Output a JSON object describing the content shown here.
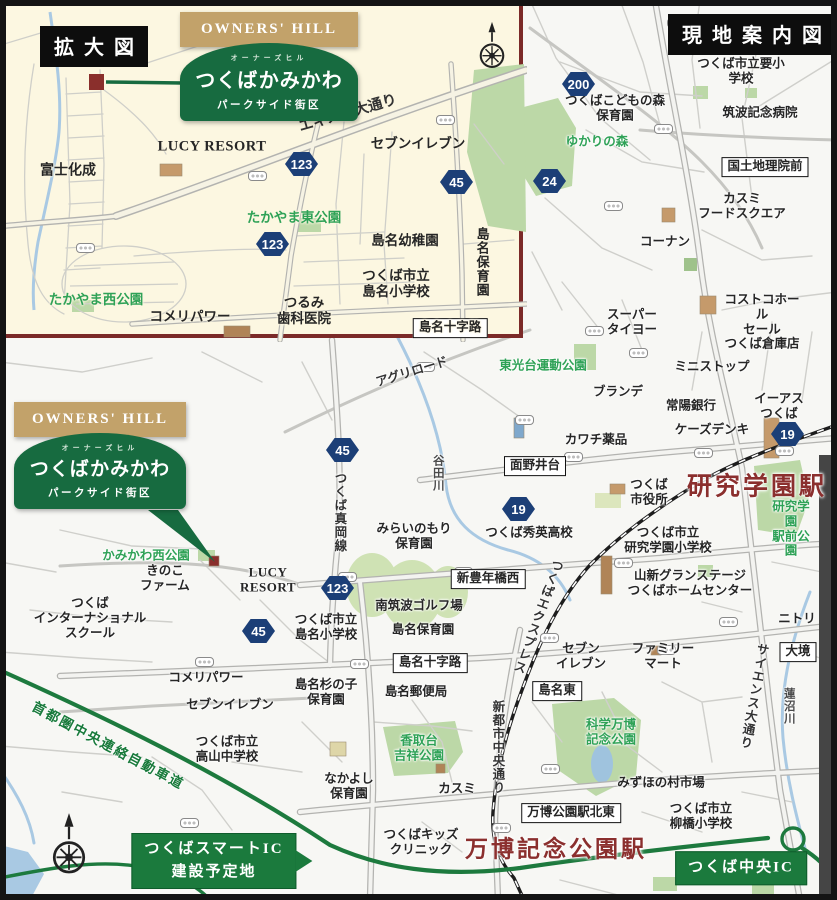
{
  "colors": {
    "accent_green": "#176b40",
    "station_red": "#8b2f2e",
    "shield_navy": "#1c3f77",
    "expressway_green": "#1d7a3e",
    "inset_bg": "#fcf7e1",
    "inset_border": "#7b2a28",
    "brand_gold": "#c2a26a"
  },
  "inset": {
    "title": "拡大図",
    "logo": {
      "brand": "OWNERS' HILL",
      "ruby": "オーナーズヒル",
      "name": "つくばかみかわ",
      "sub": "パークサイド街区"
    },
    "labels": [
      {
        "t": "かみかわ西公園",
        "x": 88,
        "y": 57,
        "c": "park",
        "fs": 14
      },
      {
        "t": "富士化成",
        "x": 64,
        "y": 168,
        "fs": 14
      },
      {
        "t": "LUCY RESORT",
        "x": 208,
        "y": 143,
        "c": "latin",
        "fs": 14.5
      },
      {
        "t": "エキスポ大通り",
        "x": 344,
        "y": 110,
        "c": "road",
        "r": -16,
        "fs": 14.5
      },
      {
        "t": "セブンイレブン",
        "x": 414,
        "y": 140,
        "fs": 13.5
      },
      {
        "t": "たかやま東公園",
        "x": 290,
        "y": 214,
        "c": "park",
        "fs": 13.5
      },
      {
        "t": "島名幼稚園",
        "x": 401,
        "y": 237,
        "fs": 13.5
      },
      {
        "t": "島名保育園",
        "x": 478,
        "y": 258,
        "c": "v",
        "fs": 13
      },
      {
        "t": "つくば市立\n島名小学校",
        "x": 392,
        "y": 280,
        "fs": 13.5
      },
      {
        "t": "つるみ\n歯科医院",
        "x": 300,
        "y": 307,
        "fs": 13.5
      },
      {
        "t": "たかやま西公園",
        "x": 92,
        "y": 296,
        "c": "park",
        "fs": 13.5
      },
      {
        "t": "コメリパワー",
        "x": 186,
        "y": 313,
        "fs": 13.5
      },
      {
        "t": "島名十字路",
        "x": 446,
        "y": 324,
        "c": "boxed"
      }
    ],
    "shields": [
      {
        "n": "123",
        "x": 297,
        "y": 160
      },
      {
        "n": "123",
        "x": 268,
        "y": 240
      },
      {
        "n": "45",
        "x": 452,
        "y": 178
      }
    ],
    "signals": [
      {
        "x": 80,
        "y": 243
      },
      {
        "x": 252,
        "y": 171
      },
      {
        "x": 440,
        "y": 115
      },
      {
        "x": 419,
        "y": 321
      }
    ]
  },
  "main": {
    "title": "現地案内図",
    "logo": {
      "brand": "OWNERS' HILL",
      "ruby": "オーナーズヒル",
      "name": "つくばかみかわ",
      "sub": "パークサイド街区"
    },
    "labels": [
      {
        "t": "つくば市立要小学校",
        "x": 741,
        "y": 71
      },
      {
        "t": "つくばこどもの森\n保育園",
        "x": 615,
        "y": 108
      },
      {
        "t": "筑波記念病院",
        "x": 760,
        "y": 113
      },
      {
        "t": "ゆかりの森",
        "x": 597,
        "y": 142,
        "c": "park"
      },
      {
        "t": "国土地理院前",
        "x": 765,
        "y": 167,
        "c": "boxed"
      },
      {
        "t": "カスミ\nフードスクエア",
        "x": 742,
        "y": 206
      },
      {
        "t": "コーナン",
        "x": 665,
        "y": 242
      },
      {
        "t": "コストコホール\nセール\nつくば倉庫店",
        "x": 762,
        "y": 322
      },
      {
        "t": "スーパー\nタイヨー",
        "x": 632,
        "y": 322
      },
      {
        "t": "ミニストップ",
        "x": 712,
        "y": 367
      },
      {
        "t": "東光台運動公園",
        "x": 543,
        "y": 366,
        "c": "park"
      },
      {
        "t": "アグリロード",
        "x": 412,
        "y": 372,
        "r": -17,
        "c": "road"
      },
      {
        "t": "ブランデ",
        "x": 618,
        "y": 392
      },
      {
        "t": "常陽銀行",
        "x": 691,
        "y": 406
      },
      {
        "t": "イーアス\nつくば",
        "x": 779,
        "y": 406
      },
      {
        "t": "ケーズデンキ",
        "x": 712,
        "y": 430
      },
      {
        "t": "カワチ薬品",
        "x": 596,
        "y": 440
      },
      {
        "t": "谷田川",
        "x": 437,
        "y": 473,
        "c": "river v"
      },
      {
        "t": "面野井台",
        "x": 535,
        "y": 466,
        "c": "boxed"
      },
      {
        "t": "つくば\n市役所",
        "x": 649,
        "y": 492
      },
      {
        "t": "研究学園駅",
        "x": 757,
        "y": 487,
        "c": "station",
        "fs": 25
      },
      {
        "t": "研究学園\n駅前公園",
        "x": 791,
        "y": 529,
        "c": "park"
      },
      {
        "t": "つくば秀英高校",
        "x": 529,
        "y": 533
      },
      {
        "t": "つくば市立\n研究学園小学校",
        "x": 668,
        "y": 540
      },
      {
        "t": "山新グランステージ\nつくばホームセンター",
        "x": 690,
        "y": 583
      },
      {
        "t": "みらいのもり\n保育園",
        "x": 414,
        "y": 536
      },
      {
        "t": "新豊年橋西",
        "x": 488,
        "y": 579,
        "c": "boxed"
      },
      {
        "t": "つくば真岡線",
        "x": 339,
        "y": 512,
        "c": "road v"
      },
      {
        "t": "南筑波ゴルフ場",
        "x": 419,
        "y": 606
      },
      {
        "t": "島名保育園",
        "x": 423,
        "y": 630
      },
      {
        "t": "つくば市立\n島名小学校",
        "x": 326,
        "y": 627
      },
      {
        "t": "かみかわ西公園",
        "x": 146,
        "y": 556,
        "c": "park"
      },
      {
        "t": "きのこ\nファーム",
        "x": 165,
        "y": 578
      },
      {
        "t": "LUCY\nRESORT",
        "x": 268,
        "y": 580,
        "c": "latin"
      },
      {
        "t": "つくば\nインターナショナル\nスクール",
        "x": 90,
        "y": 618
      },
      {
        "t": "コメリパワー",
        "x": 206,
        "y": 678
      },
      {
        "t": "島名杉の子\n保育園",
        "x": 326,
        "y": 692
      },
      {
        "t": "島名郵便局",
        "x": 416,
        "y": 692
      },
      {
        "t": "島名十字路",
        "x": 430,
        "y": 663,
        "c": "boxed"
      },
      {
        "t": "セブンイレブン",
        "x": 230,
        "y": 705
      },
      {
        "t": "セブン\nイレブン",
        "x": 581,
        "y": 656
      },
      {
        "t": "ファミリー\nマート",
        "x": 663,
        "y": 656
      },
      {
        "t": "島名東",
        "x": 557,
        "y": 691,
        "c": "boxed"
      },
      {
        "t": "つくば市立\n高山中学校",
        "x": 227,
        "y": 749
      },
      {
        "t": "香取台\n吉祥公園",
        "x": 419,
        "y": 748,
        "c": "park"
      },
      {
        "t": "科学万博\n記念公園",
        "x": 611,
        "y": 732,
        "c": "park"
      },
      {
        "t": "なかよし\n保育園",
        "x": 349,
        "y": 786
      },
      {
        "t": "サイエンス大通り",
        "x": 753,
        "y": 696,
        "c": "road v",
        "r": 10
      },
      {
        "t": "蓮沼川",
        "x": 788,
        "y": 706,
        "c": "river v"
      },
      {
        "t": "ニトリ",
        "x": 797,
        "y": 619
      },
      {
        "t": "大境",
        "x": 798,
        "y": 652,
        "c": "boxed"
      },
      {
        "t": "みずほの村市場",
        "x": 661,
        "y": 783
      },
      {
        "t": "つくば市立\n柳橋小学校",
        "x": 701,
        "y": 816
      },
      {
        "t": "万博公園駅北東",
        "x": 571,
        "y": 813,
        "c": "boxed"
      },
      {
        "t": "カスミ",
        "x": 457,
        "y": 789
      },
      {
        "t": "新都市中央通り",
        "x": 497,
        "y": 747,
        "c": "road v"
      },
      {
        "t": "つくばエクスプレス",
        "x": 537,
        "y": 616,
        "c": "road v",
        "r": 20
      },
      {
        "t": "つくばキッズ\nクリニック",
        "x": 421,
        "y": 842
      },
      {
        "t": "万博記念公園駅",
        "x": 556,
        "y": 849,
        "c": "station",
        "fs": 23
      },
      {
        "t": "首都圏中央連絡自動車道",
        "x": 108,
        "y": 746,
        "c": "exroad",
        "r": 28
      },
      {
        "t": "つくばスマートIC\n建設予定地",
        "x": 214,
        "y": 861,
        "c": "greenbox arrow"
      },
      {
        "t": "つくば中央IC",
        "x": 741,
        "y": 868,
        "c": "greenbox"
      }
    ],
    "shields": [
      {
        "n": "200",
        "x": 578,
        "y": 84
      },
      {
        "n": "24",
        "x": 549,
        "y": 181
      },
      {
        "n": "19",
        "x": 787,
        "y": 434
      },
      {
        "n": "19",
        "x": 518,
        "y": 509
      },
      {
        "n": "45",
        "x": 342,
        "y": 450
      },
      {
        "n": "123",
        "x": 337,
        "y": 588
      },
      {
        "n": "45",
        "x": 258,
        "y": 631
      }
    ],
    "signals": [
      {
        "x": 675,
        "y": 22
      },
      {
        "x": 748,
        "y": 44
      },
      {
        "x": 662,
        "y": 128
      },
      {
        "x": 612,
        "y": 205
      },
      {
        "x": 593,
        "y": 330
      },
      {
        "x": 637,
        "y": 352
      },
      {
        "x": 424,
        "y": 366
      },
      {
        "x": 523,
        "y": 419
      },
      {
        "x": 572,
        "y": 456
      },
      {
        "x": 702,
        "y": 452
      },
      {
        "x": 783,
        "y": 450
      },
      {
        "x": 346,
        "y": 576
      },
      {
        "x": 462,
        "y": 571
      },
      {
        "x": 622,
        "y": 562
      },
      {
        "x": 203,
        "y": 661
      },
      {
        "x": 358,
        "y": 663
      },
      {
        "x": 548,
        "y": 637
      },
      {
        "x": 665,
        "y": 649
      },
      {
        "x": 727,
        "y": 621
      },
      {
        "x": 398,
        "y": 690
      },
      {
        "x": 549,
        "y": 768
      },
      {
        "x": 500,
        "y": 827
      },
      {
        "x": 188,
        "y": 822
      }
    ]
  }
}
